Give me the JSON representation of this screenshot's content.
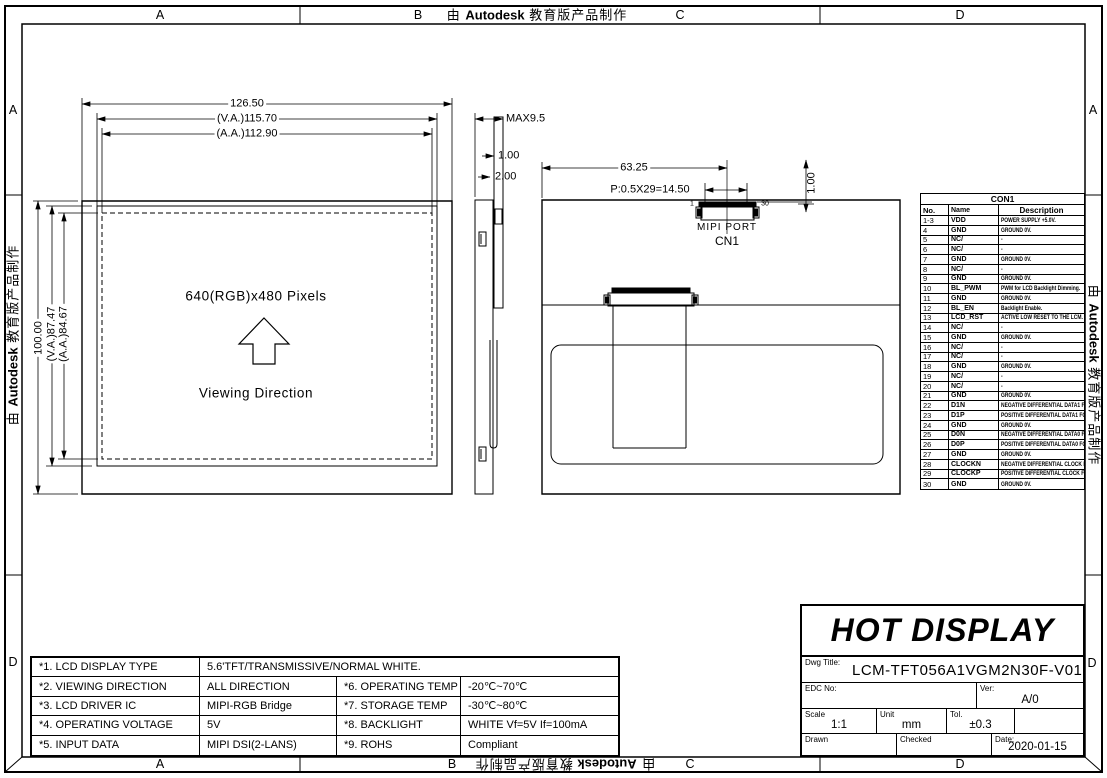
{
  "watermark": {
    "prefix": "由",
    "brand": "Autodesk",
    "suffix": "教育版产品制作"
  },
  "border": {
    "top": [
      "A",
      "B",
      "C",
      "D"
    ],
    "bottom": [
      "A",
      "B",
      "C",
      "D"
    ],
    "left": [
      "A",
      "D"
    ],
    "right": [
      "A",
      "D"
    ]
  },
  "front_view": {
    "width_dims": [
      "126.50",
      "(V.A.)115.70",
      "(A.A.)112.90"
    ],
    "height_dims": [
      "100.00",
      "(V.A.)87.47",
      "(A.A.)84.67"
    ],
    "resolution": "640(RGB)x480  Pixels",
    "viewing_direction": "Viewing  Direction"
  },
  "side_view": {
    "max_thickness": "MAX9.5",
    "dim_top": "1.00",
    "dim_bottom": "2.00"
  },
  "back_view": {
    "dim_width": "63.25",
    "pitch": "P:0.5X29=14.50",
    "dim_offset": "1.00",
    "pin_first": "1",
    "pin_last": "30",
    "port_label": "MIPI  PORT",
    "connector_label": "CN1"
  },
  "con1_table": {
    "title": "CON1",
    "headers": [
      "No.",
      "Name",
      "Description"
    ],
    "rows": [
      [
        "1-3",
        "VDD",
        "POWER SUPPLY +5.0V."
      ],
      [
        "4",
        "GND",
        "GROUND 0V."
      ],
      [
        "5",
        "NC/",
        "-"
      ],
      [
        "6",
        "NC/",
        "-"
      ],
      [
        "7",
        "GND",
        "GROUND 0V."
      ],
      [
        "8",
        "NC/",
        "-"
      ],
      [
        "9",
        "GND",
        "GROUND 0V."
      ],
      [
        "10",
        "BL_PWM",
        "PWM for LCD Backlight Dimming."
      ],
      [
        "11",
        "GND",
        "GROUND 0V."
      ],
      [
        "12",
        "BL_EN",
        "Backlight Enable."
      ],
      [
        "13",
        "LCD_RST",
        "ACTIVE LOW RESET TO THE LCM."
      ],
      [
        "14",
        "NC/",
        "-"
      ],
      [
        "15",
        "GND",
        "GROUND 0V."
      ],
      [
        "16",
        "NC/",
        "-"
      ],
      [
        "17",
        "NC/",
        "-"
      ],
      [
        "18",
        "GND",
        "GROUND 0V."
      ],
      [
        "19",
        "NC/",
        "-"
      ],
      [
        "20",
        "NC/",
        "-"
      ],
      [
        "21",
        "GND",
        "GROUND 0V."
      ],
      [
        "22",
        "D1N",
        "NEGATIVE DIFFERENTIAL DATA1 FOR DSI."
      ],
      [
        "23",
        "D1P",
        "POSITIVE DIFFERENTIAL DATA1 FOR DSI."
      ],
      [
        "24",
        "GND",
        "GROUND 0V."
      ],
      [
        "25",
        "D0N",
        "NEGATIVE DIFFERENTIAL DATA0 FOR DSI."
      ],
      [
        "26",
        "D0P",
        "POSITIVE DIFFERENTIAL DATA0 FOR DSI."
      ],
      [
        "27",
        "GND",
        "GROUND 0V."
      ],
      [
        "28",
        "CLOCKN",
        "NEGATIVE DIFFERENTIAL CLOCK FOR DSI."
      ],
      [
        "29",
        "CLOCKP",
        "POSITIVE DIFFERENTIAL CLOCK FOR DSI."
      ],
      [
        "30",
        "GND",
        "GROUND 0V."
      ]
    ]
  },
  "spec_table": {
    "rows": [
      [
        "*1. LCD  DISPLAY  TYPE",
        "5.6'TFT/TRANSMISSIVE/NORMAL  WHITE."
      ],
      [
        "*2. VIEWING  DIRECTION",
        "ALL  DIRECTION",
        "*6. OPERATING  TEMP",
        "-20℃~70℃"
      ],
      [
        "*3. LCD  DRIVER  IC",
        "MIPI-RGB  Bridge",
        "*7. STORAGE  TEMP",
        "-30℃~80℃"
      ],
      [
        "*4. OPERATING  VOLTAGE",
        "5V",
        "*8. BACKLIGHT",
        "WHITE  Vf=5V  If=100mA"
      ],
      [
        "*5. INPUT  DATA",
        "MIPI  DSI(2-LANS)",
        "*9. ROHS",
        "Compliant"
      ]
    ]
  },
  "title_block": {
    "company": "HOT DISPLAY",
    "dwg_title_label": "Dwg  Title:",
    "dwg_title": "LCM-TFT056A1VGM2N30F-V01",
    "edc_label": "EDC  No:",
    "ver_label": "Ver:",
    "ver": "A/0",
    "scale_label": "Scale",
    "scale": "1:1",
    "unit_label": "Unit",
    "unit": "mm",
    "tol_label": "Tol.",
    "tol": "±0.3",
    "drawn_label": "Drawn",
    "checked_label": "Checked",
    "date_label": "Date:",
    "date": "2020-01-15"
  }
}
